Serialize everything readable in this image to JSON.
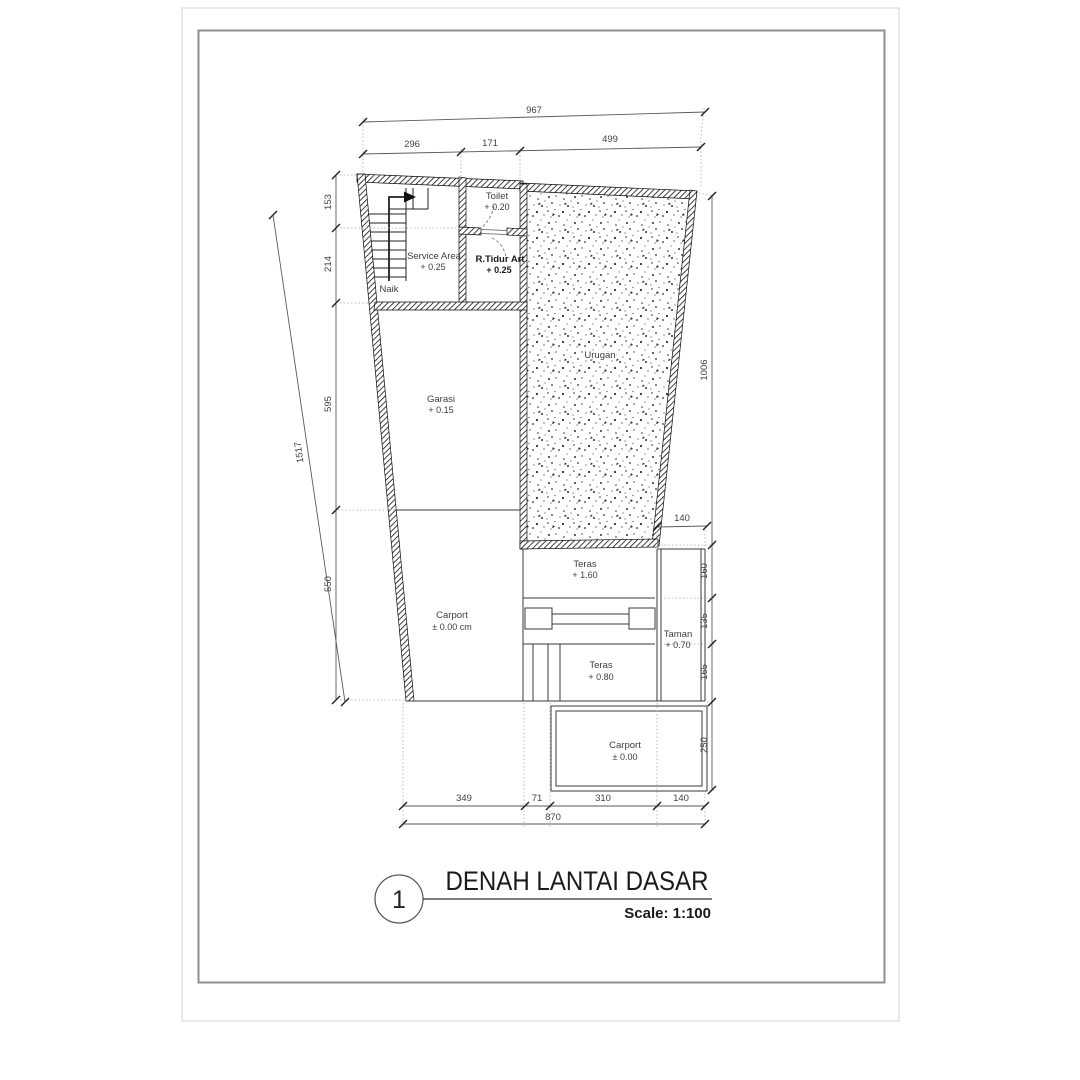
{
  "title_block": {
    "number": "1",
    "title": "DENAH  LANTAI DASAR",
    "scale": "Scale: 1:100"
  },
  "stair_label": "Naik",
  "rooms": {
    "toilet": {
      "name": "Toilet",
      "level": "+ 0.20"
    },
    "service": {
      "name": "Service Area",
      "level": "+ 0.25"
    },
    "tidur": {
      "name": "R.Tidur Art",
      "level": "+ 0.25"
    },
    "urugan": {
      "name": "Urugan"
    },
    "garasi": {
      "name": "Garasi",
      "level": "+ 0.15"
    },
    "carport_main": {
      "name": "Carport",
      "level": "± 0.00 cm"
    },
    "teras_upper": {
      "name": "Teras",
      "level": "+ 1.60"
    },
    "taman": {
      "name": "Taman",
      "level": "+ 0.70"
    },
    "teras_lower": {
      "name": "Teras",
      "level": "+ 0.80"
    },
    "carport_front": {
      "name": "Carport",
      "level": "± 0.00"
    }
  },
  "dims": {
    "top_total": "967",
    "top_segments": [
      "296",
      "171",
      "499"
    ],
    "left_segments": [
      "153",
      "214",
      "595",
      "550"
    ],
    "left_overall": "1517",
    "right_height": "1006",
    "taman_width": "140",
    "right_segments": [
      "160",
      "135",
      "165",
      "250"
    ],
    "bottom_segments": [
      "349",
      "71",
      "310",
      "140"
    ],
    "bottom_total": "870"
  },
  "colors": {
    "paper": "#ffffff",
    "frame": "#8f8f8f",
    "wall": "#0d0d0d",
    "dimension": "#5a5a5a"
  }
}
